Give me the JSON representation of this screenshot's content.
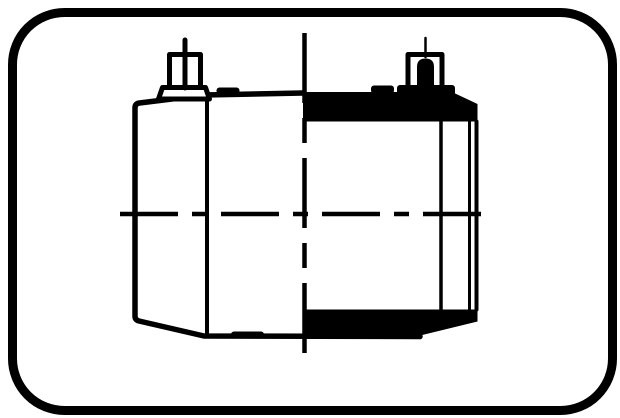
{
  "colors": {
    "line": "#000000",
    "section_fill": "#000000",
    "background": "#ffffff"
  },
  "diagram": {
    "type": "technical-drawing",
    "subject": "electrofusion-coupling",
    "views": {
      "left": "exterior-elevation",
      "right": "half-section"
    },
    "parts": [
      "coupler-body",
      "terminal-pin-left",
      "terminal-pin-right",
      "fusion-indicators",
      "pipe-socket-end",
      "centerline-horizontal",
      "centerline-vertical"
    ]
  }
}
